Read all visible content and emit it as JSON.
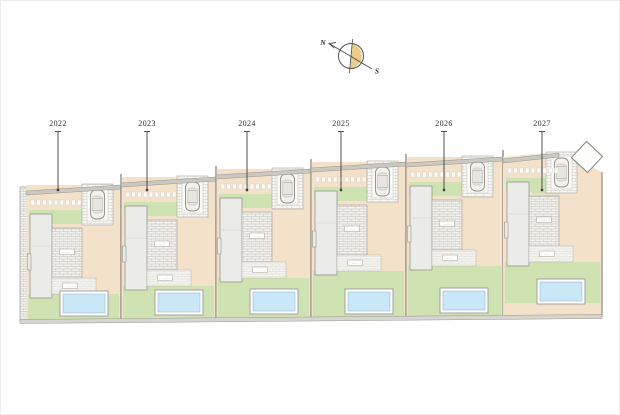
{
  "compass": {
    "north_label": "N",
    "south_label": "S"
  },
  "plots": [
    {
      "year": "2022"
    },
    {
      "year": "2023"
    },
    {
      "year": "2024"
    },
    {
      "year": "2025"
    },
    {
      "year": "2026"
    },
    {
      "year": "2027"
    }
  ],
  "micro": {
    "terrace_label": "·····",
    "paving_label": "·····"
  },
  "colors": {
    "paper": "#ffffff",
    "driveway_tan": "#f3e1c9",
    "grass_green": "#cfe3b2",
    "pool_blue": "#c9e7f7",
    "pool_frame": "#ffffff",
    "house_gray": "#ebebe9",
    "house_stroke": "#97958d",
    "wall_band": "#cbc8c2",
    "wall_line": "#8f8d85",
    "brick_line": "#c9c7c0",
    "paving_line": "#dbd9d3",
    "compass_sand": "#eccb8d",
    "line_dark": "#3f3f3f",
    "label_text": "#2e2e2e"
  }
}
